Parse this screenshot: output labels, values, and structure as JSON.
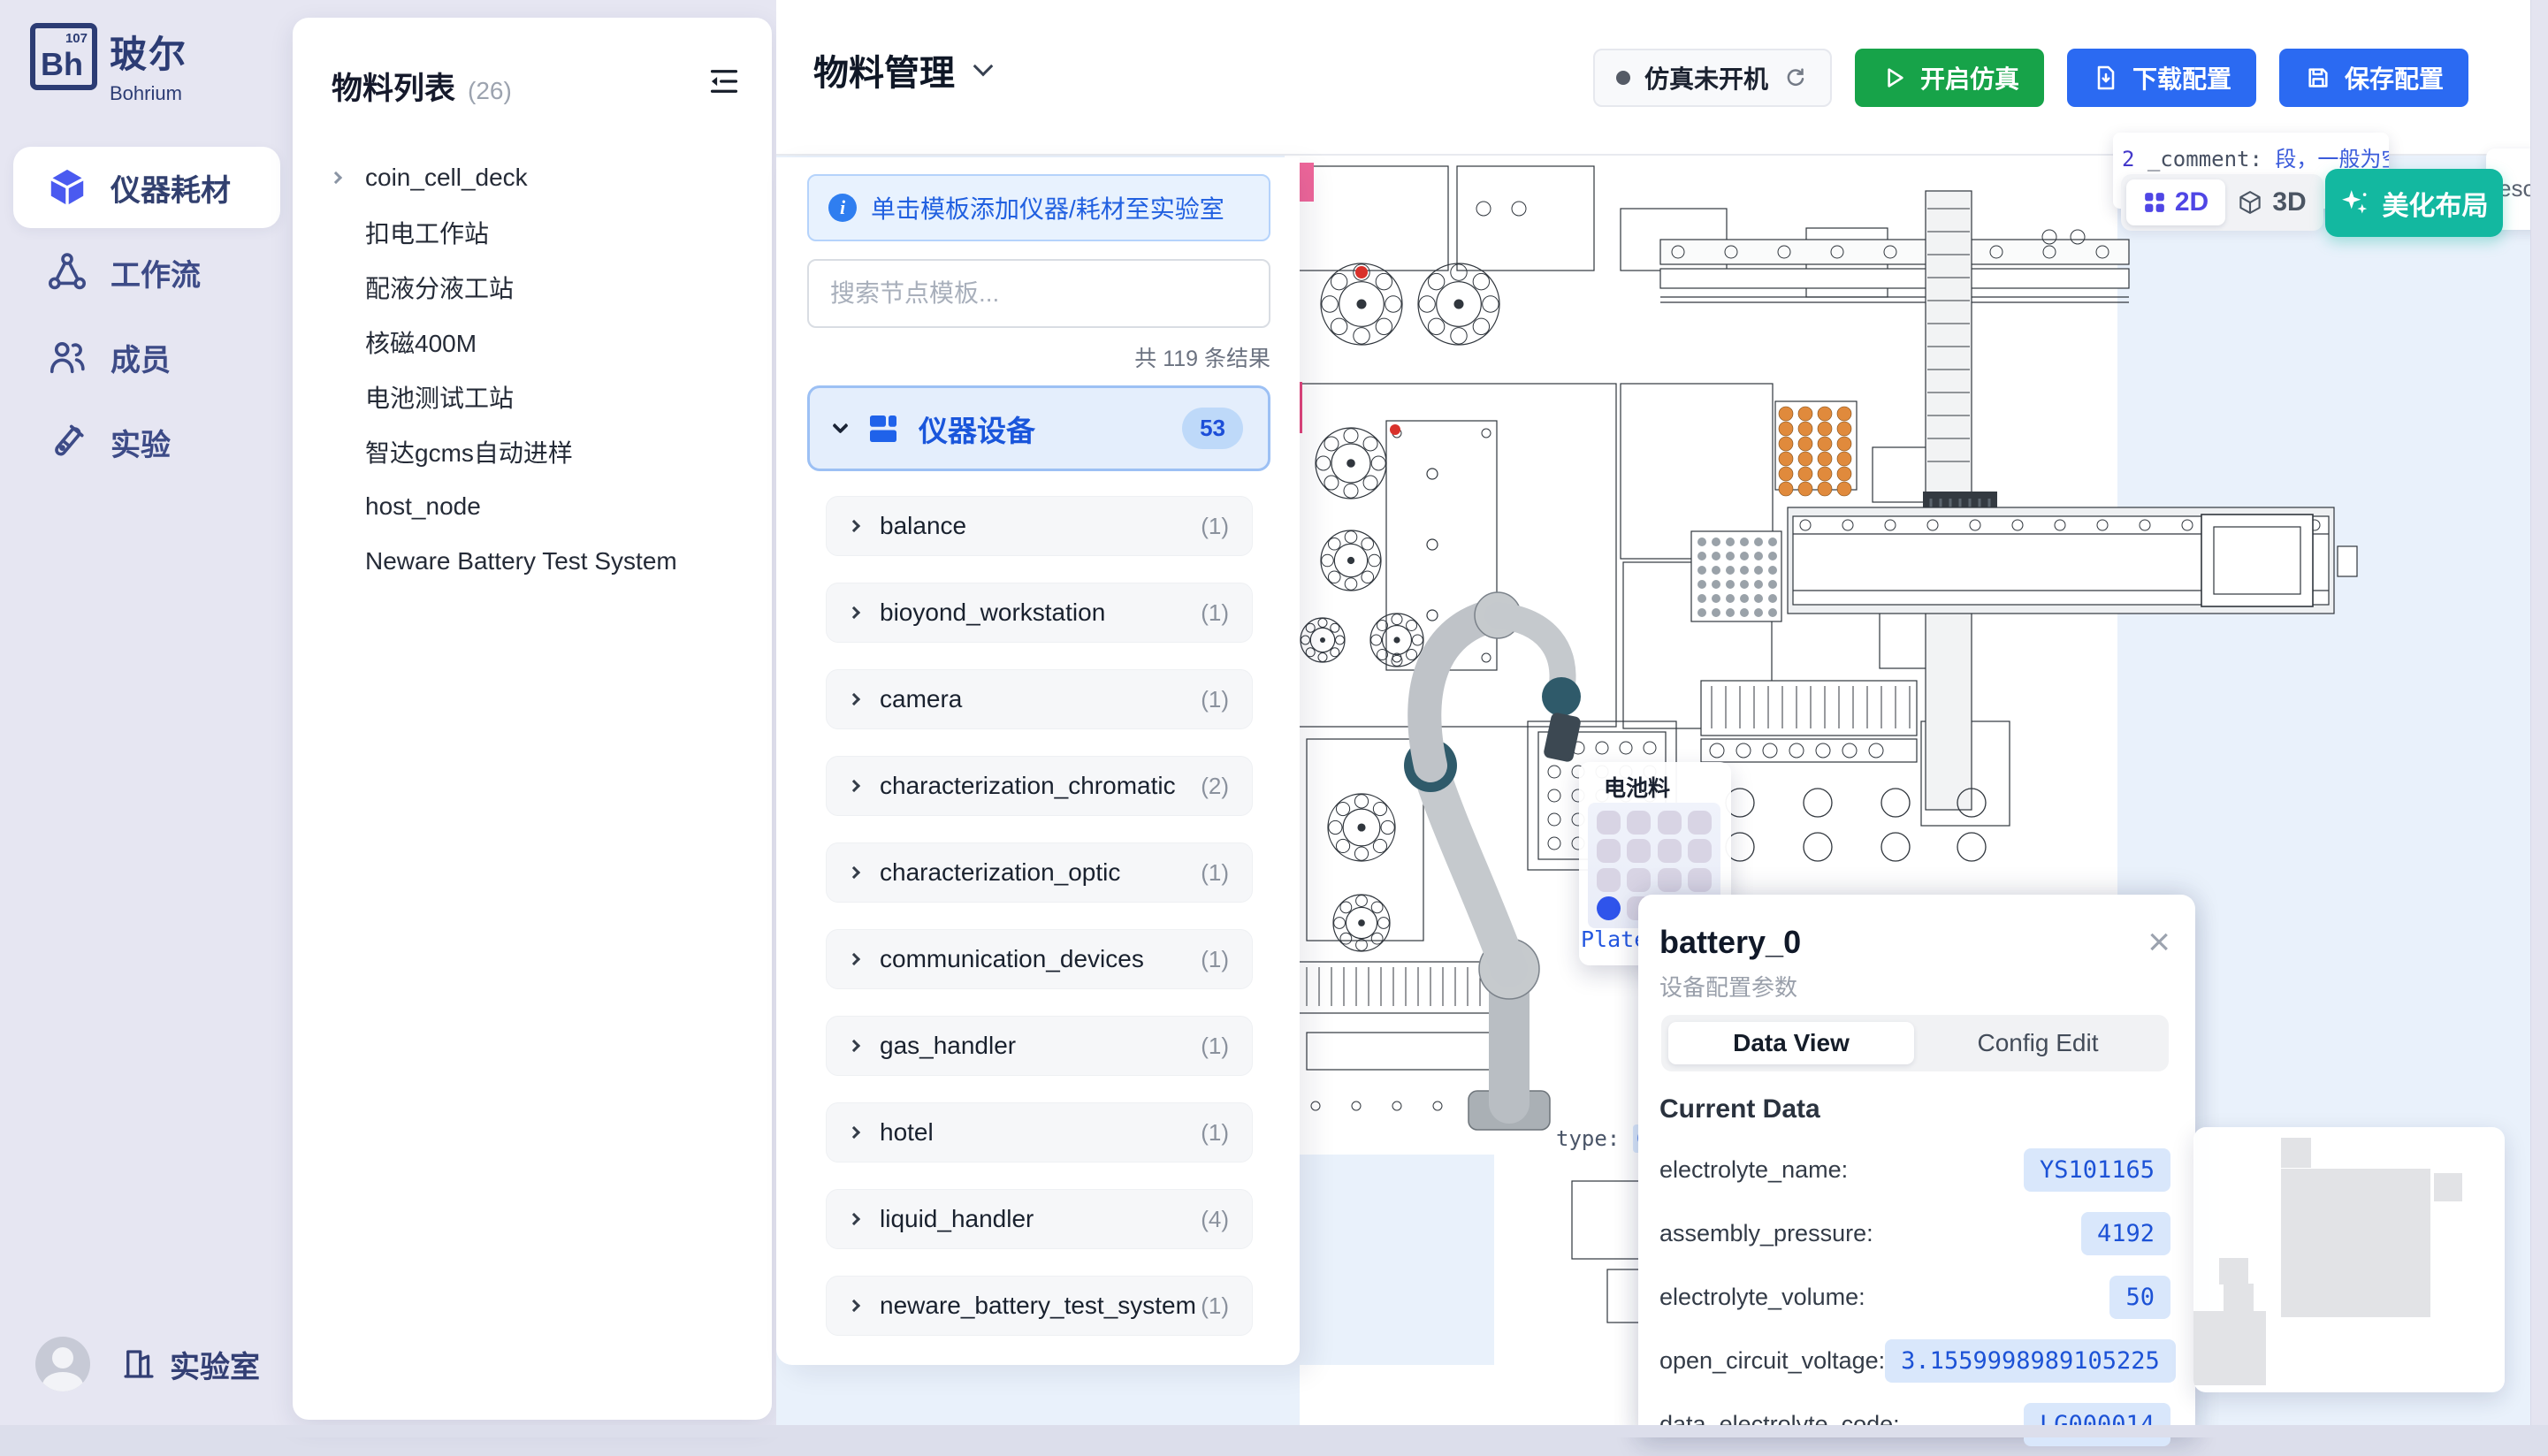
{
  "brand": {
    "symbol": "Bh",
    "number": "107",
    "name_zh": "玻尔",
    "name_en": "Bohrium"
  },
  "sidebar": {
    "items": [
      {
        "label": "仪器耗材",
        "icon": "cube-icon",
        "active": true
      },
      {
        "label": "工作流",
        "icon": "workflow-icon",
        "active": false
      },
      {
        "label": "成员",
        "icon": "members-icon",
        "active": false
      },
      {
        "label": "实验",
        "icon": "experiment-icon",
        "active": false
      }
    ],
    "footer": {
      "label": "实验室"
    }
  },
  "material_panel": {
    "title": "物料列表",
    "count": "(26)",
    "items": [
      {
        "label": "coin_cell_deck",
        "expandable": true
      },
      {
        "label": "扣电工作站",
        "expandable": false
      },
      {
        "label": "配液分液工站",
        "expandable": false
      },
      {
        "label": "核磁400M",
        "expandable": false
      },
      {
        "label": "电池测试工站",
        "expandable": false
      },
      {
        "label": "智达gcms自动进样",
        "expandable": false
      },
      {
        "label": "host_node",
        "expandable": false
      },
      {
        "label": "Neware Battery Test System",
        "expandable": false
      }
    ]
  },
  "topbar": {
    "title": "物料管理",
    "status_label": "仿真未开机",
    "start_label": "开启仿真",
    "download_label": "下载配置",
    "save_label": "保存配置"
  },
  "template_panel": {
    "banner": "单击模板添加仪器/耗材至实验室",
    "search_placeholder": "搜索节点模板...",
    "results": "共 119 条结果",
    "group": {
      "label": "仪器设备",
      "badge": "53"
    },
    "items": [
      {
        "label": "balance",
        "count": "(1)"
      },
      {
        "label": "bioyond_workstation",
        "count": "(1)"
      },
      {
        "label": "camera",
        "count": "(1)"
      },
      {
        "label": "characterization_chromatic",
        "count": "(2)"
      },
      {
        "label": "characterization_optic",
        "count": "(1)"
      },
      {
        "label": "communication_devices",
        "count": "(1)"
      },
      {
        "label": "gas_handler",
        "count": "(1)"
      },
      {
        "label": "hotel",
        "count": "(1)"
      },
      {
        "label": "liquid_handler",
        "count": "(4)"
      },
      {
        "label": "neware_battery_test_system",
        "count": "(1)"
      }
    ]
  },
  "canvas": {
    "toggle": {
      "d2": "2D",
      "d3": "3D"
    },
    "beautify_label": "美化布局",
    "side_tab": "esou",
    "code_tooltip": {
      "line_no": "2",
      "key": "_comment:",
      "value": "段，一般为空，stat",
      "line2": "固定"
    },
    "type_code": {
      "key": "type:",
      "value": "Coi"
    },
    "plate_code": "Plate",
    "tray_tooltip": {
      "title": "电池料盘",
      "menu": "···",
      "rows": 4,
      "cols": 4,
      "selected_index": 12
    }
  },
  "detail_panel": {
    "title": "battery_0",
    "subtitle": "设备配置参数",
    "close": "×",
    "tabs": {
      "data_view": "Data View",
      "config_edit": "Config Edit"
    },
    "section": "Current Data",
    "rows": [
      {
        "label": "electrolyte_name:",
        "value": "YS101165"
      },
      {
        "label": "assembly_pressure:",
        "value": "4192"
      },
      {
        "label": "electrolyte_volume:",
        "value": "50"
      },
      {
        "label": "open_circuit_voltage:",
        "value": "3.1559998989105225"
      },
      {
        "label": "data_electrolyte_code:",
        "value": "LG000014"
      }
    ]
  },
  "colors": {
    "accent_blue": "#2b6af2",
    "green": "#17a349",
    "teal": "#13b8a0",
    "indigo": "#4f46e5",
    "value_pill": "#d9e7fb",
    "canvas_bg": "#e9f1fb"
  }
}
